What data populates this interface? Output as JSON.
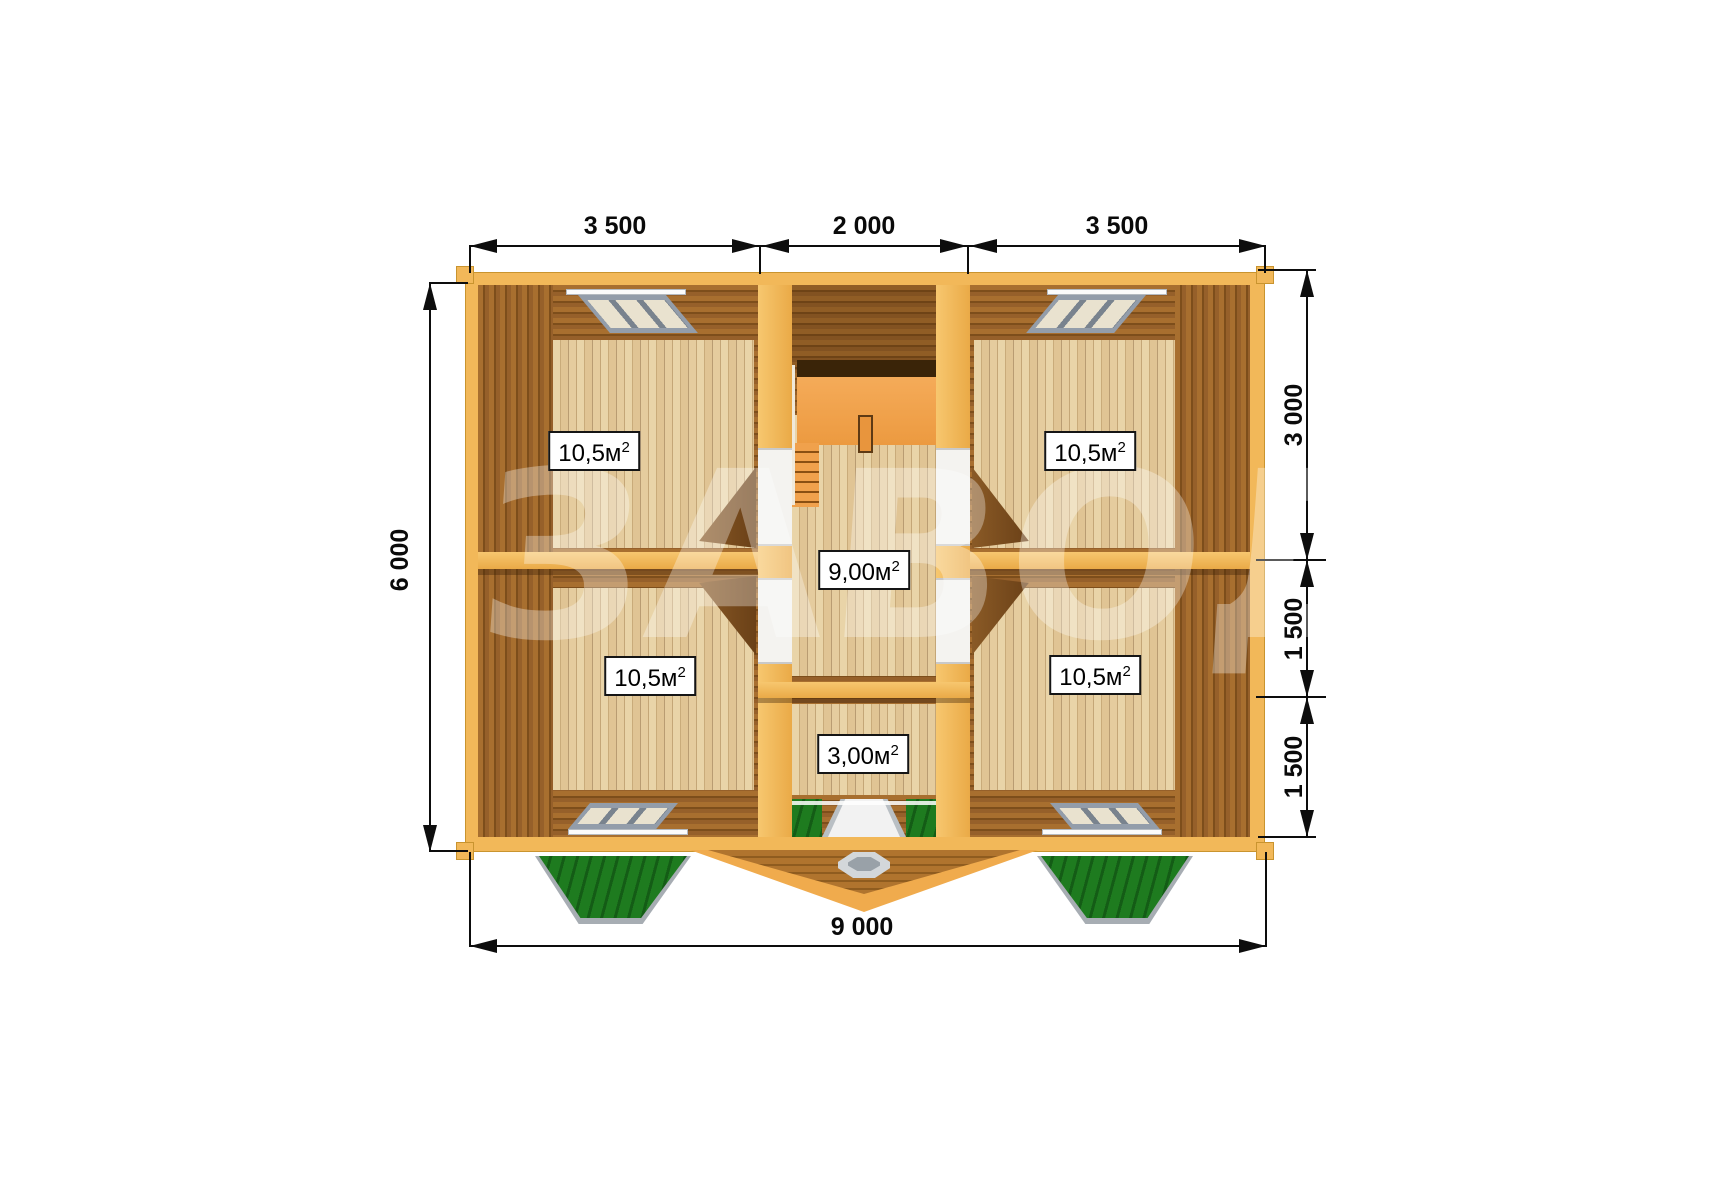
{
  "dimensions": {
    "top": [
      "3 500",
      "2 000",
      "3 500"
    ],
    "left": "6 000",
    "right": [
      "3 000",
      "1 500",
      "1 500"
    ],
    "bottom": "9 000"
  },
  "rooms": [
    {
      "name": "top-left-room",
      "area": "10,5м",
      "sup": "2"
    },
    {
      "name": "top-right-room",
      "area": "10,5м",
      "sup": "2"
    },
    {
      "name": "hallway",
      "area": "9,00м",
      "sup": "2"
    },
    {
      "name": "bottom-left-room",
      "area": "10,5м",
      "sup": "2"
    },
    {
      "name": "bottom-right-room",
      "area": "10,5м",
      "sup": "2"
    },
    {
      "name": "entry-room",
      "area": "3,00м",
      "sup": "2"
    }
  ],
  "watermark": "ЗАВОД",
  "colors": {
    "wall_yellow": "#f2b859",
    "log_brown": "#96602a",
    "floor_tan": "#e5cc9e",
    "stair_orange": "#f0a14c",
    "grass_green": "#1e7b1f",
    "window_gray": "#939daa",
    "dimension_black": "#0d0d0d"
  }
}
